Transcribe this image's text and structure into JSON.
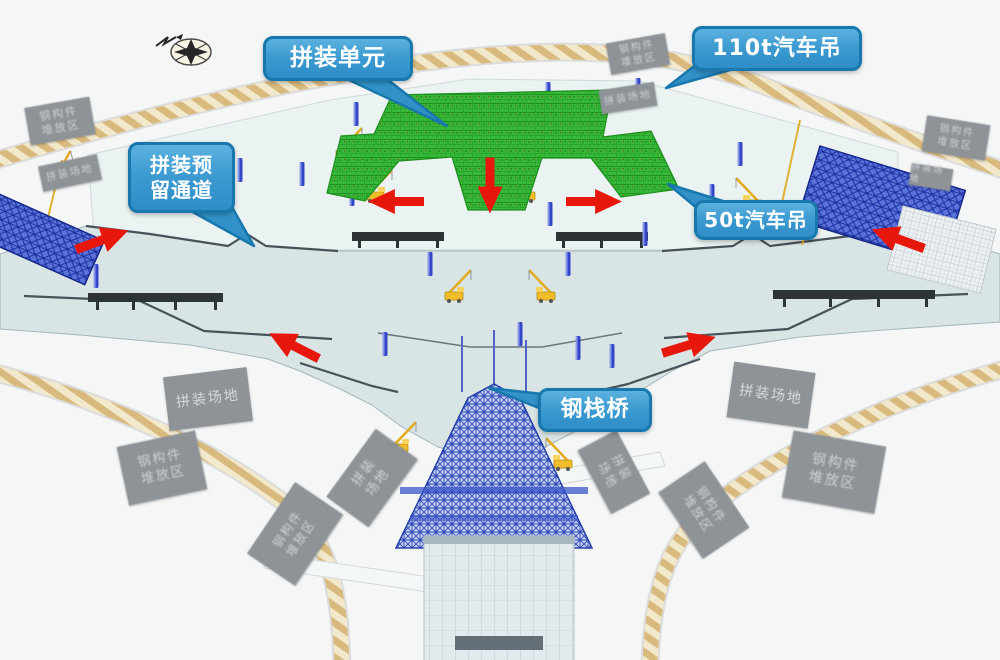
{
  "callouts": [
    {
      "id": "assembly-unit",
      "text": "拼装单元"
    },
    {
      "id": "truck-crane-110t",
      "text": "110t汽车吊"
    },
    {
      "id": "assembly-reserved-passage",
      "lines": [
        "拼装预",
        "留通道"
      ]
    },
    {
      "id": "truck-crane-50t",
      "text": "50t汽车吊"
    },
    {
      "id": "steel-trestle-bridge",
      "text": "钢栈桥"
    }
  ],
  "road_signs": [
    {
      "id": "sign-nw-road",
      "lines": [
        "钢构件",
        "堆放区"
      ]
    },
    {
      "id": "sign-west-apron",
      "lines": [
        "拼装场地"
      ]
    },
    {
      "id": "sign-north-road-upper",
      "lines": [
        "钢构件",
        "堆放区"
      ]
    },
    {
      "id": "sign-north-apron",
      "lines": [
        "拼装场地"
      ]
    },
    {
      "id": "sign-ne-road",
      "lines": [
        "钢构件",
        "堆放区"
      ]
    },
    {
      "id": "sign-east-apron",
      "lines": [
        "拼装场地"
      ]
    },
    {
      "id": "sign-sw-assembly-yard",
      "lines": [
        "拼装场地"
      ]
    },
    {
      "id": "sign-se-assembly-yard",
      "lines": [
        "拼装场地"
      ]
    },
    {
      "id": "sign-sw-stockyard",
      "lines": [
        "钢构件",
        "堆放区"
      ]
    },
    {
      "id": "sign-se-stockyard",
      "lines": [
        "钢构件",
        "堆放区"
      ]
    },
    {
      "id": "sign-sw-inner-yard",
      "lines": [
        "拼装",
        "场地"
      ]
    },
    {
      "id": "sign-sw-inner-stockyard",
      "lines": [
        "钢构件",
        "堆放区"
      ]
    },
    {
      "id": "sign-se-inner-yard",
      "lines": [
        "拼装",
        "场地"
      ]
    },
    {
      "id": "sign-se-inner-stockyard",
      "lines": [
        "钢构件",
        "堆放区"
      ]
    }
  ],
  "flow_arrows": [
    {
      "id": "green-area-left",
      "direction": "left"
    },
    {
      "id": "green-area-down",
      "direction": "down"
    },
    {
      "id": "green-area-right",
      "direction": "right"
    },
    {
      "id": "west-edge",
      "direction": "up-right"
    },
    {
      "id": "east-edge",
      "direction": "up-left"
    },
    {
      "id": "southwest-wing",
      "direction": "up-left"
    },
    {
      "id": "southeast-wing",
      "direction": "up-right"
    }
  ],
  "colors": {
    "callout_fill": "#3d9bd1",
    "callout_border": "#1878ae",
    "arrow_red": "#e8170b",
    "assembly_unit_green": "#39b93a",
    "road_tan": "#d9ba7e",
    "apron_slab": "#d9e5e5",
    "structure_blue": "#3a52c4",
    "sign_gray": "#8e9398"
  }
}
